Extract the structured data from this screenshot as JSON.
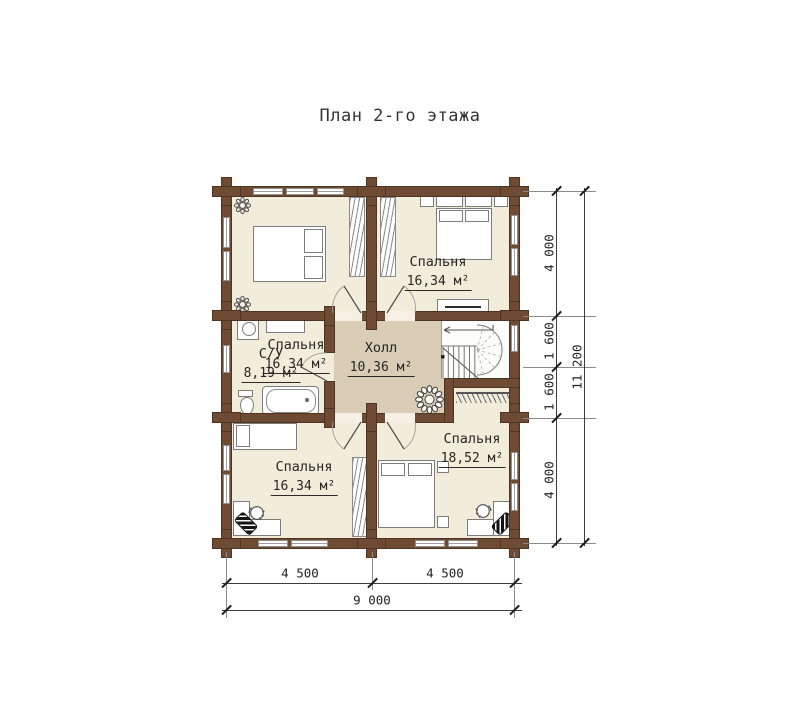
{
  "title": "План 2-го этажа",
  "rooms": {
    "bedroom_tl": {
      "name": "Спальня",
      "area": "16,34 м²"
    },
    "bedroom_tr": {
      "name": "Спальня",
      "area": "16,34 м²"
    },
    "bathroom": {
      "name": "С/У",
      "area": "8,19 м²"
    },
    "hall": {
      "name": "Холл",
      "area": "10,36 м²"
    },
    "bedroom_bl": {
      "name": "Спальня",
      "area": "16,34 м²"
    },
    "bedroom_br": {
      "name": "Спальня",
      "area": "18,52 м²"
    }
  },
  "dimensions": {
    "right": [
      "4 000",
      "1 600",
      "1 600",
      "4 000"
    ],
    "right_total": "11 200",
    "bottom": [
      "4 500",
      "4 500"
    ],
    "bottom_total": "9 000"
  },
  "icons": {
    "ceiling_light": "ceiling-light-icon",
    "plant": "plant-icon",
    "office_chair": "office-chair-icon"
  },
  "colors": {
    "wall": "#6f4b33",
    "room_floor": "#f2ecda",
    "hall_floor": "#d9cdb6",
    "line": "#7c7c7c",
    "text": "#262626"
  }
}
